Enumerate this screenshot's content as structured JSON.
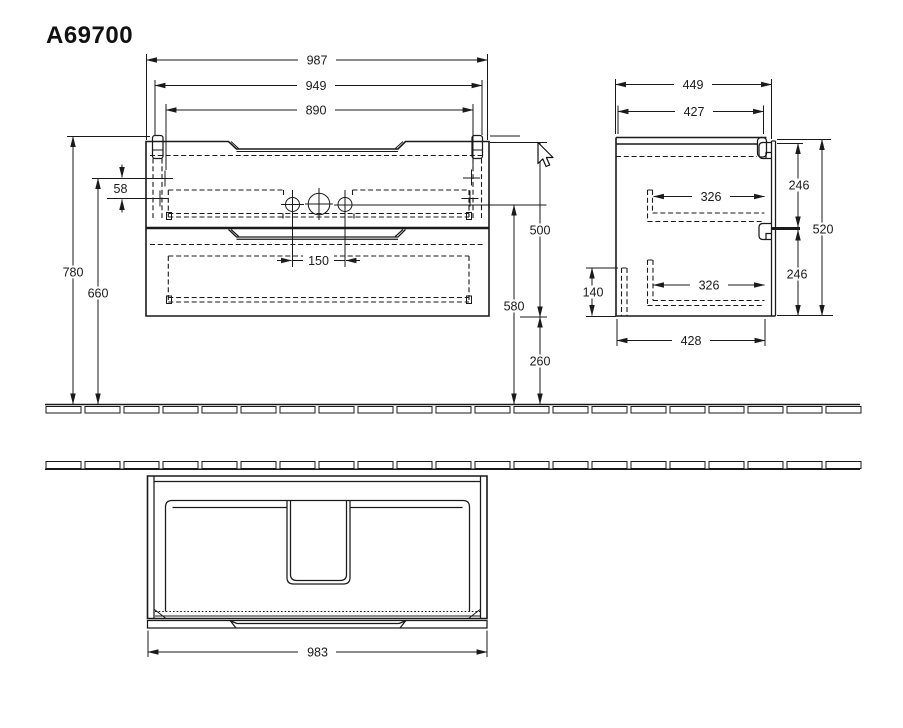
{
  "title": "A69700",
  "colors": {
    "line": "#1a1a1a",
    "background": "#ffffff"
  },
  "front_view": {
    "overall_width": "987",
    "rail_width": "949",
    "inner_width": "890",
    "rail_hole_gap": "58",
    "height_to_top": "780",
    "height_to_rail_holes": "660",
    "body_height": "500",
    "height_to_tap_holes": "580",
    "floor_clearance": "260",
    "tap_hole_spacing": "150"
  },
  "side_view": {
    "overall_depth": "449",
    "top_depth": "427",
    "upper_drawer_depth": "326",
    "lower_drawer_depth": "326",
    "upper_section_height": "246",
    "lower_section_height": "246",
    "body_height": "520",
    "front_bottom_height": "140",
    "bottom_depth": "428"
  },
  "plan_view": {
    "body_width": "983"
  }
}
